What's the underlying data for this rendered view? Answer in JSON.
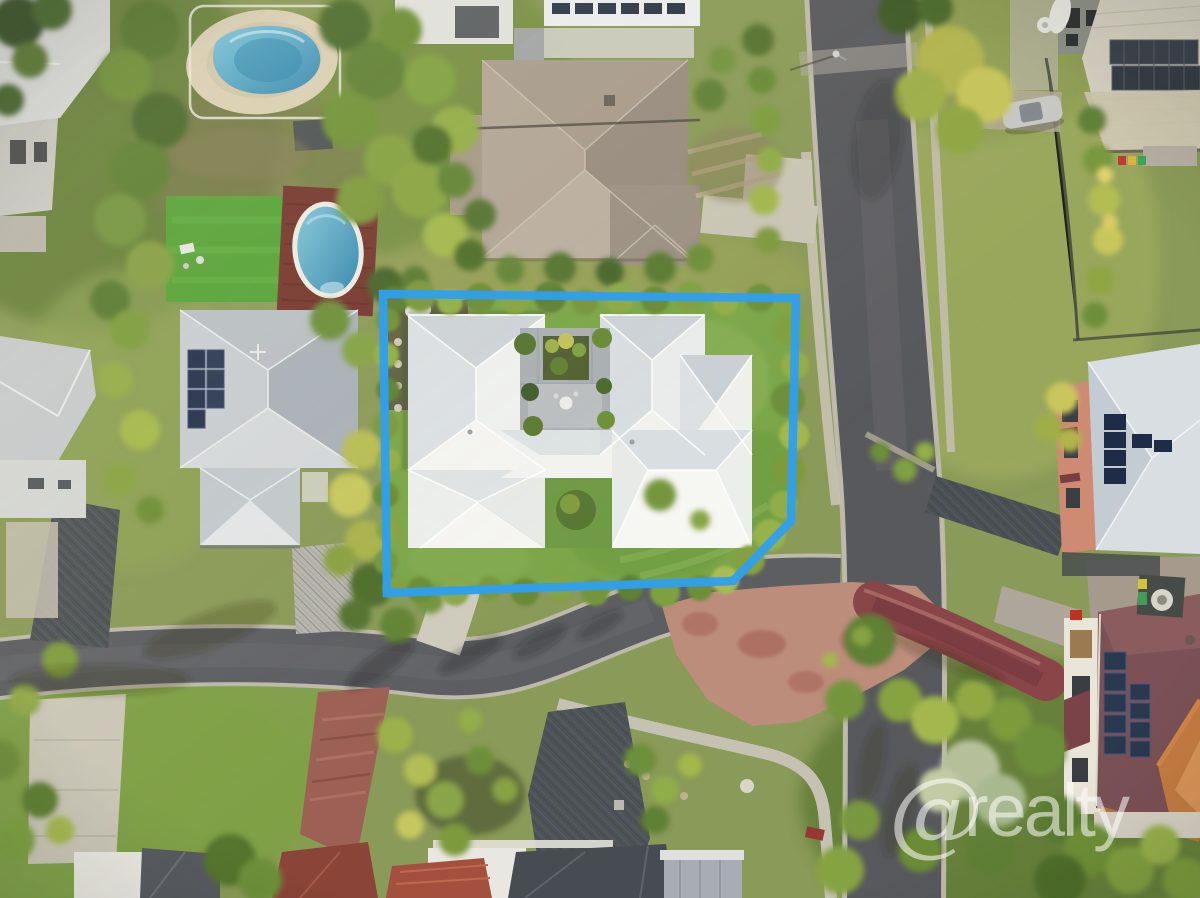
{
  "meta": {
    "description": "Aerial drone photograph of a suburban residential neighbourhood; one property lot is outlined in blue",
    "width_px": 1200,
    "height_px": 898
  },
  "watermark": {
    "symbol": "@",
    "text": "realty",
    "color": "#ffffff",
    "opacity": "0.55"
  },
  "boundary": {
    "label": "featured lot boundary",
    "color": "#2f9fee",
    "stroke_width": "8.5",
    "points": "383,294 796,298 791,521 733,581 387,593"
  },
  "palette": {
    "asphalt": "#5b5c60",
    "concrete": "#cbc7b8",
    "kerb": "#bdb9ab",
    "lawn_bright": "#7aa648",
    "lawn_olive": "#93a257",
    "hedge_dark": "#4f6e2c",
    "hedge_light": "#a3b74d",
    "featured_roof_white": "#f0f1ef",
    "roof_gray": "#b9bfc5",
    "roof_tile_brown": "#a79b8c",
    "roof_maroon": "#7b5156",
    "roof_orange": "#c57c42",
    "wall_salmon": "#cf8a74",
    "solar_panel": "#2a3850",
    "pool_water": "#4fa8cc",
    "pool_deck_red": "#76382f",
    "brick_path": "#9c6054",
    "intersection_paving": "#bd8d7c",
    "bike_path_red": "#8a4549"
  },
  "scene": {
    "features": [
      "featured-property-lot",
      "featured-house-white-roof",
      "courtyard-garden",
      "swimming-pool-freeform",
      "swimming-pool-oval",
      "artificial-turf-lawn",
      "neighbor-house-west",
      "neighbor-house-northwest-tiled",
      "house-northeast-solar",
      "house-east-salmon",
      "house-southeast-maroon",
      "houses-south",
      "side-road",
      "main-street",
      "intersection-red-paving",
      "red-bike-path",
      "driveways",
      "hedges-and-trees",
      "parked-car",
      "wheelie-bins",
      "street-lamp"
    ]
  }
}
